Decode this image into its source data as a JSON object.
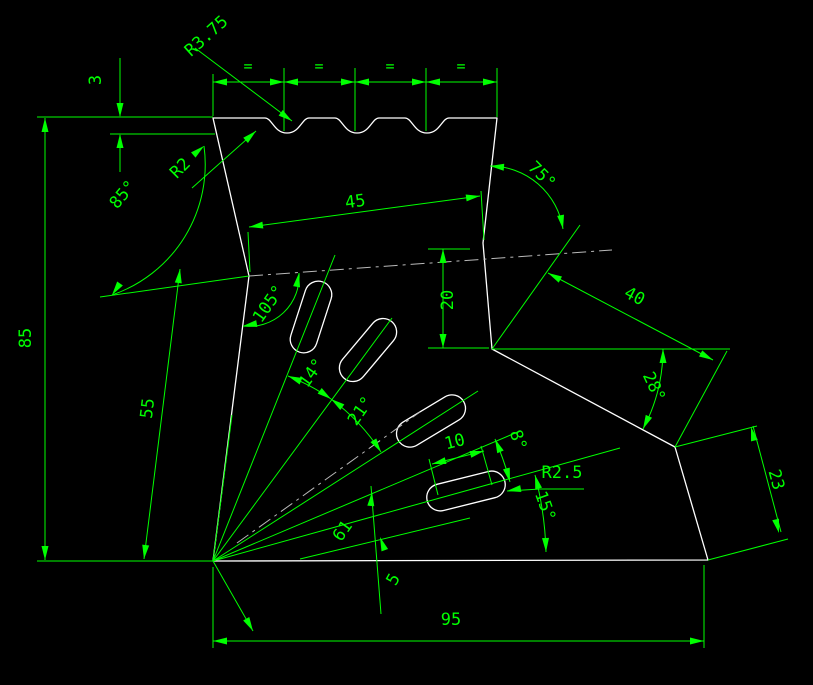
{
  "canvas": {
    "width": 813,
    "height": 685,
    "background": "#000000"
  },
  "colors": {
    "geometry": "#ffffff",
    "dimension": "#00ff00",
    "centerline": "#b9b9b9"
  },
  "drawing": {
    "type": "cad-part-drawing",
    "dims": {
      "scallop_radius": "R3.75",
      "equal_mark": "=",
      "scallop_depth": "3",
      "corner_radius": "R2",
      "left_top_angle": "85°",
      "top_width": "45",
      "right_top_angle": "75°",
      "overall_height": "85",
      "left_edge_length": "55",
      "left_vertex_angle": "105°",
      "right_step_depth": "20",
      "upper_right_edge": "40",
      "right_edge_angle": "28°",
      "fan_angle_1": "14°",
      "fan_angle_2": "21°",
      "slot_spacing": "10",
      "fan_angle_3": "8°",
      "slot_end_radius": "R2.5",
      "lower_right_edge": "23",
      "fan_angle_4": "15°",
      "apex_to_slot": "61",
      "slot_offset": "5",
      "base_width": "95"
    }
  }
}
